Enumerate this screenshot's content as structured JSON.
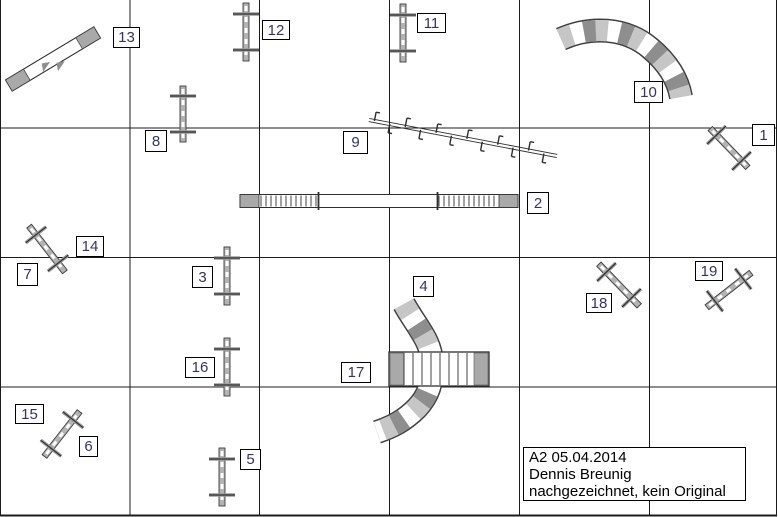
{
  "window": {
    "width": 778,
    "height": 517
  },
  "info_box": {
    "line1": "A2 05.04.2014",
    "line2": "Dennis Breunig",
    "line3": "nachgezeichnet, kein Original",
    "x": 523,
    "y": 447,
    "w": 223,
    "h": 54
  },
  "colors": {
    "grid": "#1c1c1c",
    "bar_fill": "#b3b3b3",
    "bar_stroke": "#3c3c3c",
    "dash_white": "#ffffff",
    "cross_gray": "#9c9c9c",
    "cross_dark": "#2e2e2e",
    "tunnel_light": "#c6c6c6",
    "tunnel_dark": "#8e8e8e",
    "tunnel_outline": "#3f3f3f",
    "contact_zone": "#a9a9a9",
    "plank_white": "#ffffff",
    "outline_dark": "#2f2f2f",
    "number_color": "#333366",
    "arrow_gray": "#8f8f8f"
  },
  "grid": {
    "verticals": [
      0.5,
      130,
      259.5,
      389.5,
      519.5,
      649.5,
      776.5
    ],
    "horizontals": [
      128,
      257.5,
      387,
      515.5
    ],
    "top_border": false
  },
  "number_labels": [
    {
      "num": "1",
      "x": 752,
      "y": 124,
      "w": 23,
      "h": 22
    },
    {
      "num": "2",
      "x": 527,
      "y": 192,
      "w": 22,
      "h": 22
    },
    {
      "num": "3",
      "x": 192,
      "y": 266,
      "w": 21,
      "h": 22
    },
    {
      "num": "4",
      "x": 413,
      "y": 276,
      "w": 21,
      "h": 21
    },
    {
      "num": "5",
      "x": 240,
      "y": 449,
      "w": 21,
      "h": 21
    },
    {
      "num": "6",
      "x": 79,
      "y": 436,
      "w": 19,
      "h": 21
    },
    {
      "num": "7",
      "x": 17,
      "y": 263,
      "w": 21,
      "h": 23
    },
    {
      "num": "8",
      "x": 145,
      "y": 130,
      "w": 22,
      "h": 22
    },
    {
      "num": "9",
      "x": 343,
      "y": 131,
      "w": 25,
      "h": 23
    },
    {
      "num": "10",
      "x": 634,
      "y": 81,
      "w": 29,
      "h": 22
    },
    {
      "num": "11",
      "x": 417,
      "y": 13,
      "w": 29,
      "h": 20
    },
    {
      "num": "12",
      "x": 262,
      "y": 20,
      "w": 28,
      "h": 20
    },
    {
      "num": "13",
      "x": 113,
      "y": 27,
      "w": 27,
      "h": 21
    },
    {
      "num": "14",
      "x": 76,
      "y": 236,
      "w": 28,
      "h": 21
    },
    {
      "num": "15",
      "x": 15,
      "y": 404,
      "w": 29,
      "h": 20
    },
    {
      "num": "16",
      "x": 185,
      "y": 357,
      "w": 30,
      "h": 21
    },
    {
      "num": "17",
      "x": 341,
      "y": 362,
      "w": 30,
      "h": 21
    },
    {
      "num": "18",
      "x": 586,
      "y": 293,
      "w": 26,
      "h": 20
    },
    {
      "num": "19",
      "x": 695,
      "y": 261,
      "w": 28,
      "h": 20
    }
  ],
  "obstacles": {
    "jumps": [
      {
        "id": "jump-12",
        "cx": 246,
        "cy": 32,
        "angle": 90,
        "len": 58
      },
      {
        "id": "jump-11",
        "cx": 403,
        "cy": 33,
        "angle": 90,
        "len": 58
      },
      {
        "id": "jump-8",
        "cx": 183,
        "cy": 114,
        "angle": 90,
        "len": 56
      },
      {
        "id": "jump-3",
        "cx": 227,
        "cy": 276,
        "angle": 90,
        "len": 58
      },
      {
        "id": "jump-16",
        "cx": 227,
        "cy": 367,
        "angle": 90,
        "len": 58
      },
      {
        "id": "jump-5",
        "cx": 222,
        "cy": 477,
        "angle": 90,
        "len": 58
      },
      {
        "id": "jump-7-14",
        "cx": 47,
        "cy": 249,
        "angle": 52,
        "len": 58
      },
      {
        "id": "jump-15-6",
        "cx": 62,
        "cy": 434,
        "angle": -52,
        "len": 57
      },
      {
        "id": "jump-18",
        "cx": 619,
        "cy": 285,
        "angle": 46,
        "len": 58
      },
      {
        "id": "jump-19",
        "cx": 729,
        "cy": 290,
        "angle": -38,
        "len": 56
      },
      {
        "id": "jump-1",
        "cx": 729,
        "cy": 148,
        "angle": 46,
        "len": 54
      }
    ],
    "seesaw": {
      "id": "seesaw-13",
      "cx": 53,
      "cy": 59,
      "angle": -31,
      "len": 103,
      "w": 13,
      "end_len": 21
    },
    "weave": {
      "id": "weave-9",
      "x1": 369,
      "y1": 120,
      "x2": 557,
      "y2": 156,
      "poles": 12
    },
    "dogwalk": {
      "id": "dogwalk-2",
      "x1": 240,
      "x2": 518,
      "y": 194.5,
      "h": 13,
      "end_w": 19,
      "hatch1": [
        261,
        317
      ],
      "hatch2": [
        439,
        498
      ],
      "marks": [
        318.5,
        437.5
      ]
    },
    "aframe": {
      "id": "aframe-17",
      "x": 389,
      "y": 352,
      "w": 100,
      "h": 34,
      "band_w": 14,
      "slat_step": 9
    },
    "tunnels": [
      {
        "id": "tunnel-10",
        "path": "M 561 39 C 590 26 625 27 650 48 C 668 63 678 80 681 97",
        "width": 21
      },
      {
        "id": "tunnel-4",
        "path": "M 404 304 C 416 326 431 340 432 362 C 433 384 428 396 417 408 C 404 421 392 427 377 432",
        "width": 21
      }
    ]
  }
}
